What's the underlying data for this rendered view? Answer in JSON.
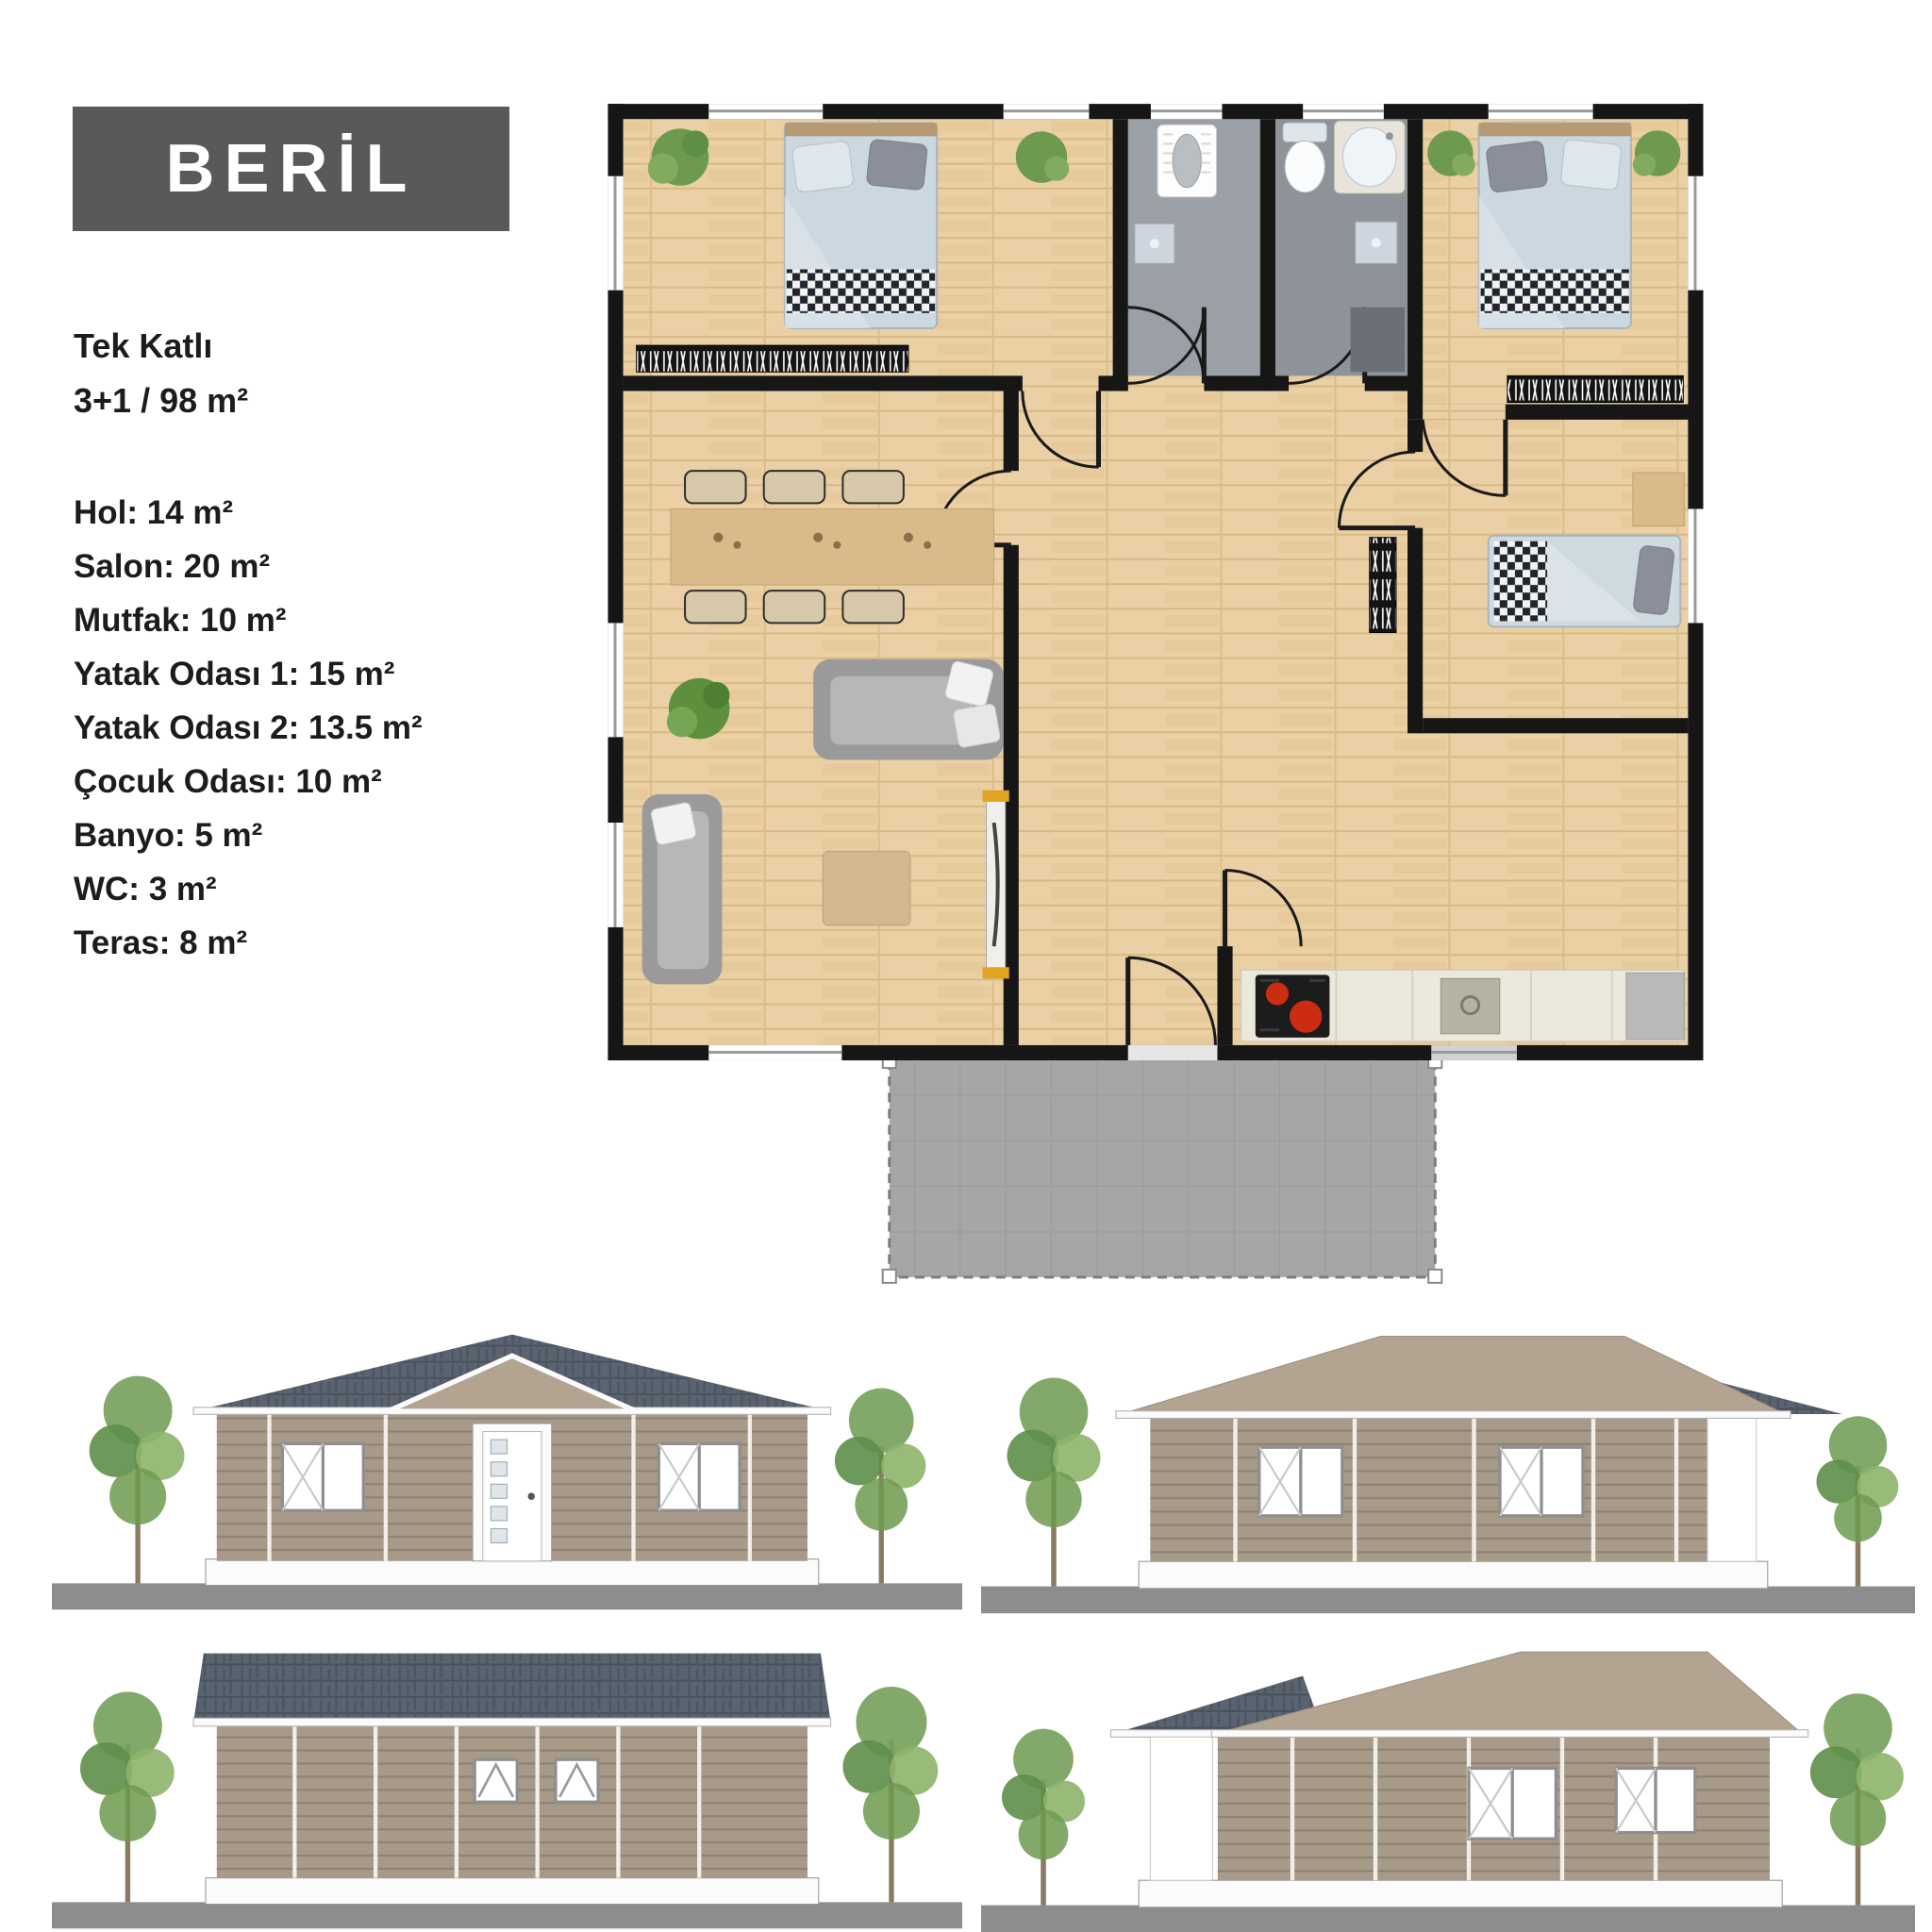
{
  "title": {
    "label": "BERİL"
  },
  "specs": {
    "line1": "Tek Katlı",
    "line2": "3+1 / 98 m²"
  },
  "rooms": {
    "lines": [
      "Hol: 14 m²",
      "Salon: 20 m²",
      "Mutfak: 10 m²",
      "Yatak Odası 1: 15 m²",
      "Yatak Odası 2: 13.5 m²",
      "Çocuk Odası: 10 m²",
      "Banyo: 5 m²",
      "WC: 3 m²",
      "Teras: 8 m²"
    ],
    "structured": [
      {
        "name": "Hol",
        "area_m2": 14
      },
      {
        "name": "Salon",
        "area_m2": 20
      },
      {
        "name": "Mutfak",
        "area_m2": 10
      },
      {
        "name": "Yatak Odası 1",
        "area_m2": 15
      },
      {
        "name": "Yatak Odası 2",
        "area_m2": 13.5
      },
      {
        "name": "Çocuk Odası",
        "area_m2": 10
      },
      {
        "name": "Banyo",
        "area_m2": 5
      },
      {
        "name": "WC",
        "area_m2": 3
      },
      {
        "name": "Teras",
        "area_m2": 8
      }
    ]
  },
  "plan": {
    "storeys": "Tek Katlı",
    "layout": "3+1",
    "total_area_m2": 98,
    "icons": [
      "double-bed-icon",
      "single-bed-icon",
      "squat-toilet-icon",
      "toilet-icon",
      "sink-icon",
      "bathtub-icon",
      "shower-icon",
      "sofa-icon",
      "dining-table-icon",
      "plant-icon",
      "stove-icon",
      "kitchen-sink-icon",
      "fridge-icon",
      "radiator-icon",
      "door-arc-icon",
      "window-icon",
      "terrace-icon",
      "tv-unit-icon"
    ]
  },
  "colors": {
    "page_bg": "#ffffff",
    "title_bg": "#595959",
    "title_fg": "#ffffff",
    "ink": "#1c1c1c",
    "wall": "#161616",
    "wood_floor": "#ead0a4",
    "wood_floor_dark": "#dfbf8e",
    "wet_floor": "#9aa0a6",
    "wet_floor_dark": "#8d9399",
    "terrace": "#a6a6a6",
    "bed_linen": "#ccd8e0",
    "blanket_check": "#20262e",
    "sofa_gray": "#9a9a9a",
    "table_tan": "#d9ba8a",
    "burner_red": "#cc2c12",
    "counter": "#ebe8dc",
    "elev_wall": "#a79a89",
    "roof_dark": "#5a6470",
    "roof_tan": "#b3a492",
    "ground": "#8d8d8d",
    "tree_green": "#76a05a"
  }
}
